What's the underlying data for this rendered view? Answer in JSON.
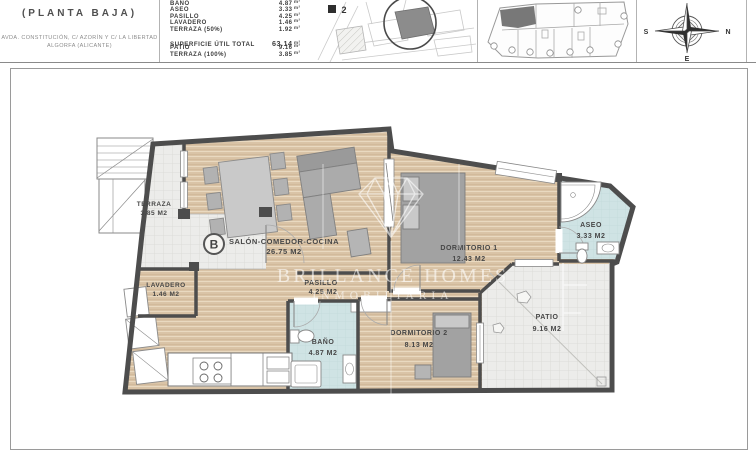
{
  "header": {
    "title": "(PLANTA BAJA)",
    "address_line1": "AVDA. CONSTITUCIÓN, C/ AZORÍN Y C/ LA LIBERTAD",
    "address_line2": "ALGORFA (ALICANTE)",
    "areas": {
      "unit": "m²",
      "rows": [
        {
          "label": "BAÑO",
          "value": "4.87"
        },
        {
          "label": "ASEO",
          "value": "3.33"
        },
        {
          "label": "PASILLO",
          "value": "4.25"
        },
        {
          "label": "LAVADERO",
          "value": "1.46"
        },
        {
          "label": "TERRAZA (50%)",
          "value": "1.92"
        }
      ],
      "total": {
        "label": "SUPERFICIE ÚTIL TOTAL",
        "value": "63.14"
      },
      "extra": [
        {
          "label": "PATIO",
          "value": "9.16"
        },
        {
          "label": "TERRAZA (100%)",
          "value": "3.85"
        }
      ]
    },
    "site_map": {
      "block_label": "2"
    },
    "compass": {
      "s": "S",
      "n": "N",
      "e": "E"
    }
  },
  "plan": {
    "unit_badge": "B",
    "rooms": {
      "terraza": {
        "name": "TERRAZA",
        "area": "3.85 M2"
      },
      "salon": {
        "name": "SALÓN-COMEDOR-COCINA",
        "area": "26.75 M2"
      },
      "dormitorio1": {
        "name": "DORMITORIO 1",
        "area": "12.43 M2"
      },
      "aseo": {
        "name": "ASEO",
        "area": "3.33 M2"
      },
      "lavadero": {
        "name": "LAVADERO",
        "area": "1.46 M2"
      },
      "pasillo": {
        "name": "PASILLO",
        "area": "4.25 M2"
      },
      "bano": {
        "name": "BAÑO",
        "area": "4.87 M2"
      },
      "dormitorio2": {
        "name": "DORMITORIO 2",
        "area": "8.13 M2"
      },
      "patio": {
        "name": "PATIO",
        "area": "9.16 M2"
      }
    },
    "watermark": {
      "line1": "BRILLANCE HOMES",
      "line2": "INMOBILIARIA"
    }
  },
  "palette": {
    "wood_floor": "#d9c3a6",
    "bath_floor": "#cfe3e4",
    "tile_floor": "#ececea",
    "wall": "#4d4d4d",
    "plot_highlight": "#8c8c8c"
  }
}
